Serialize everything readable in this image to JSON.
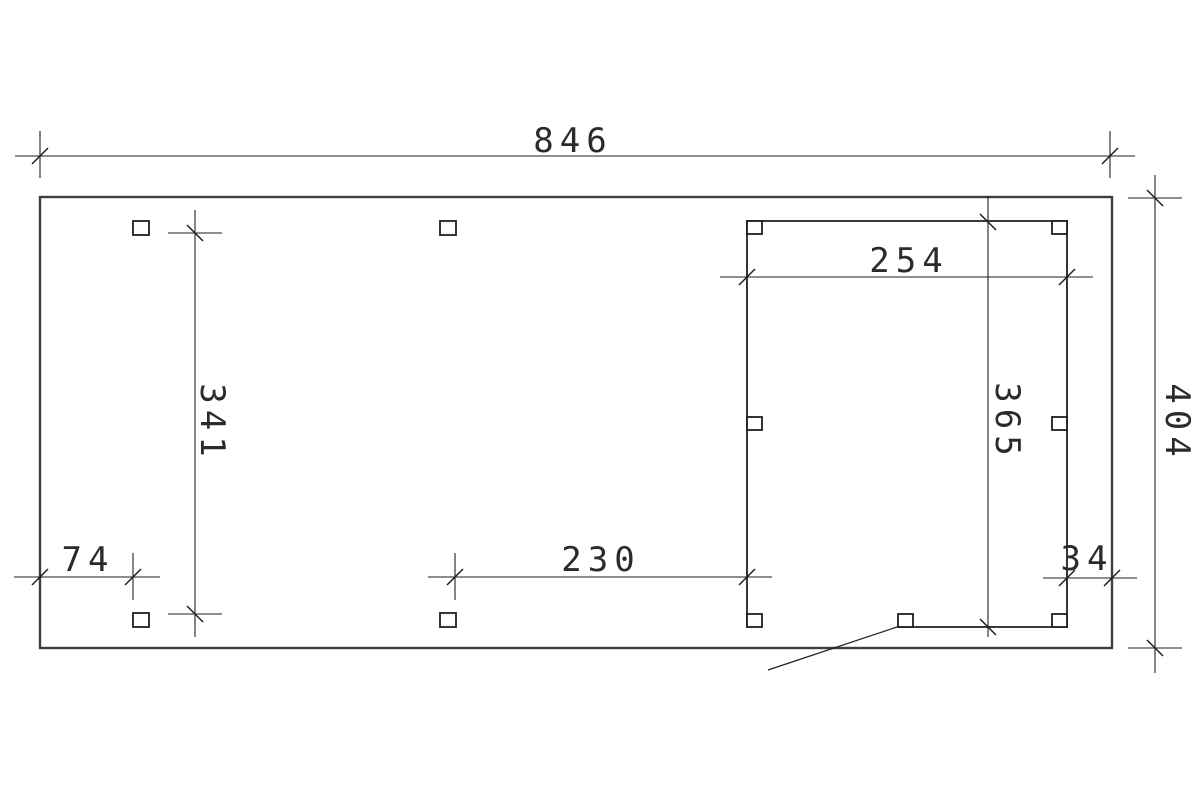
{
  "page": {
    "background": "#ffffff",
    "line_color": "#1f1f1f",
    "outer_wall_color": "#3f3f3f"
  },
  "drawing": {
    "type": "dimensioned floor plan (carport with enclosed room)",
    "dimensions": {
      "overall_width": "846",
      "overall_depth": "404",
      "left_post_spacing": "341",
      "left_offset": "74",
      "middle_post_spacing": "230",
      "enclosure_width": "254",
      "enclosure_depth": "365",
      "right_offset": "34"
    }
  }
}
